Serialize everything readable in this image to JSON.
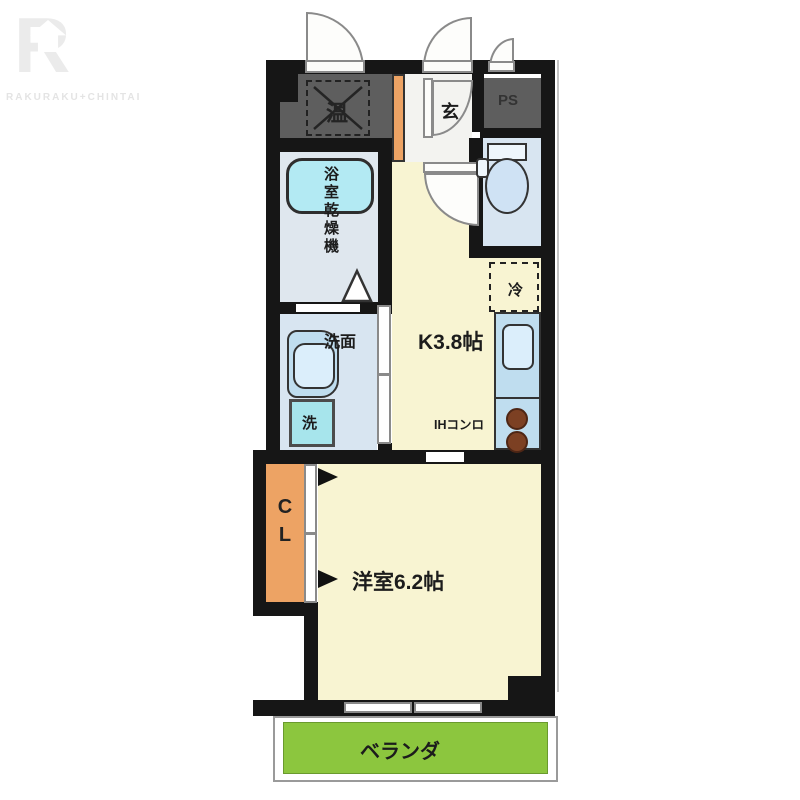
{
  "watermark": {
    "letter": "R",
    "brand": "RAKURAKU+CHINTAI"
  },
  "rooms": {
    "utility": "温",
    "entrance": "玄",
    "pipe_space": "PS",
    "bathroom": "浴室乾燥機",
    "washroom": "洗面",
    "washer": "洗",
    "kitchen": "K3.8帖",
    "fridge": "冷",
    "stove": "IHコンロ",
    "closet": "CL",
    "western_room": "洋室6.2帖",
    "balcony": "ベランダ"
  },
  "colors": {
    "wall": "#161616",
    "room_cream": "#f8f4d2",
    "water_blue": "#d8e5f1",
    "bath_blue": "#dfe7ee",
    "entrance_gray": "#f3f3f0",
    "tub_cyan": "#b3eaf3",
    "washer_cyan": "#a7e5ec",
    "counter_blue": "#bfddef",
    "sink_blue": "#dbeefb",
    "dark_gray": "#5e5e5e",
    "closet_orange": "#eda364",
    "balcony_green": "#8cc63e",
    "burner_brown": "#7c4023"
  }
}
